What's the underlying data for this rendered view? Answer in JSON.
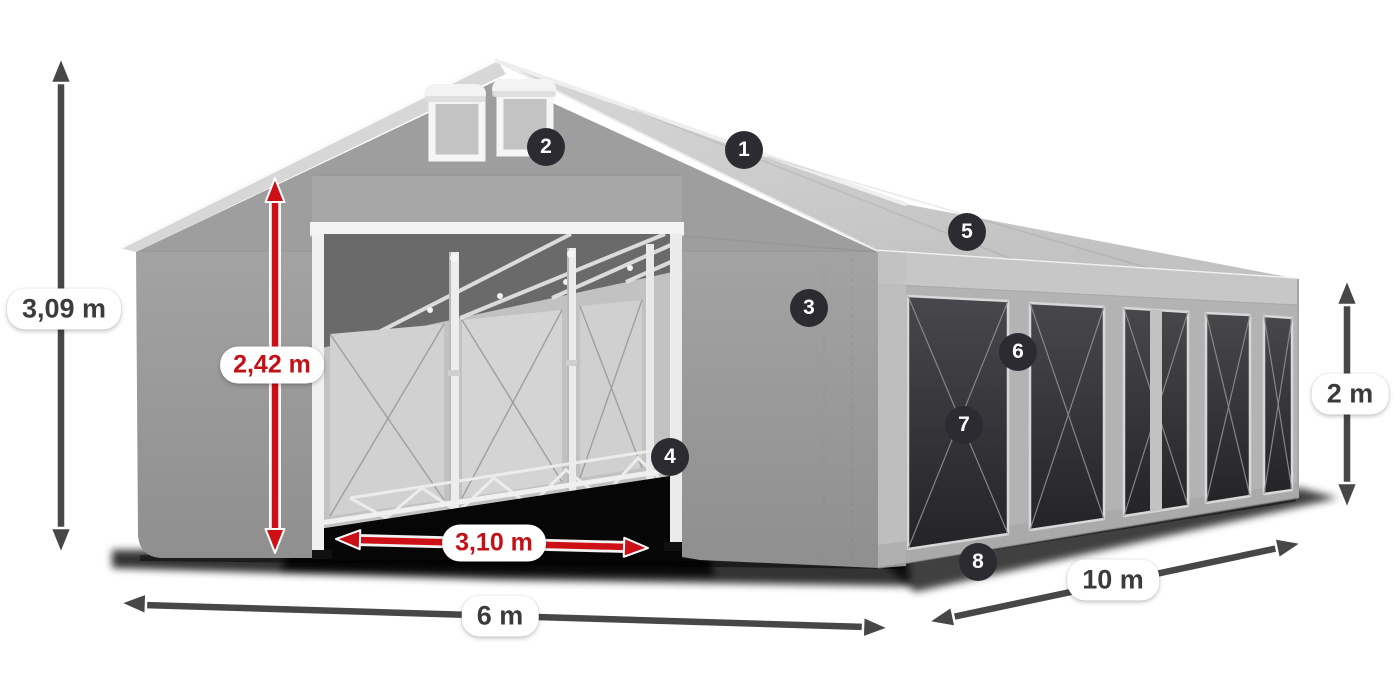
{
  "colors": {
    "background": "#ffffff",
    "dimension_dark": "#474747",
    "dimension_red": "#cc1016",
    "label_bg": "#ffffff",
    "label_text_dark": "#3b3b3b",
    "label_text_red": "#c41118",
    "badge_bg": "#2b2b31",
    "badge_text": "#ffffff",
    "tent_roof": "#cccccc",
    "tent_gable": "#9e9e9e",
    "tent_side_wall": "#b3b3b3",
    "tent_window": "#3a3a3e",
    "tent_frame_white": "#f3f3f3"
  },
  "diagram": {
    "dimensions": {
      "total_height": {
        "label": "3,09 m"
      },
      "entrance_height": {
        "label": "2,42 m"
      },
      "entrance_width": {
        "label": "3,10 m"
      },
      "front_width": {
        "label": "6 m"
      },
      "side_length": {
        "label": "10 m"
      },
      "side_height": {
        "label": "2 m"
      }
    },
    "callouts": [
      {
        "number": "1"
      },
      {
        "number": "2"
      },
      {
        "number": "3"
      },
      {
        "number": "4"
      },
      {
        "number": "5"
      },
      {
        "number": "6"
      },
      {
        "number": "7"
      },
      {
        "number": "8"
      }
    ]
  }
}
